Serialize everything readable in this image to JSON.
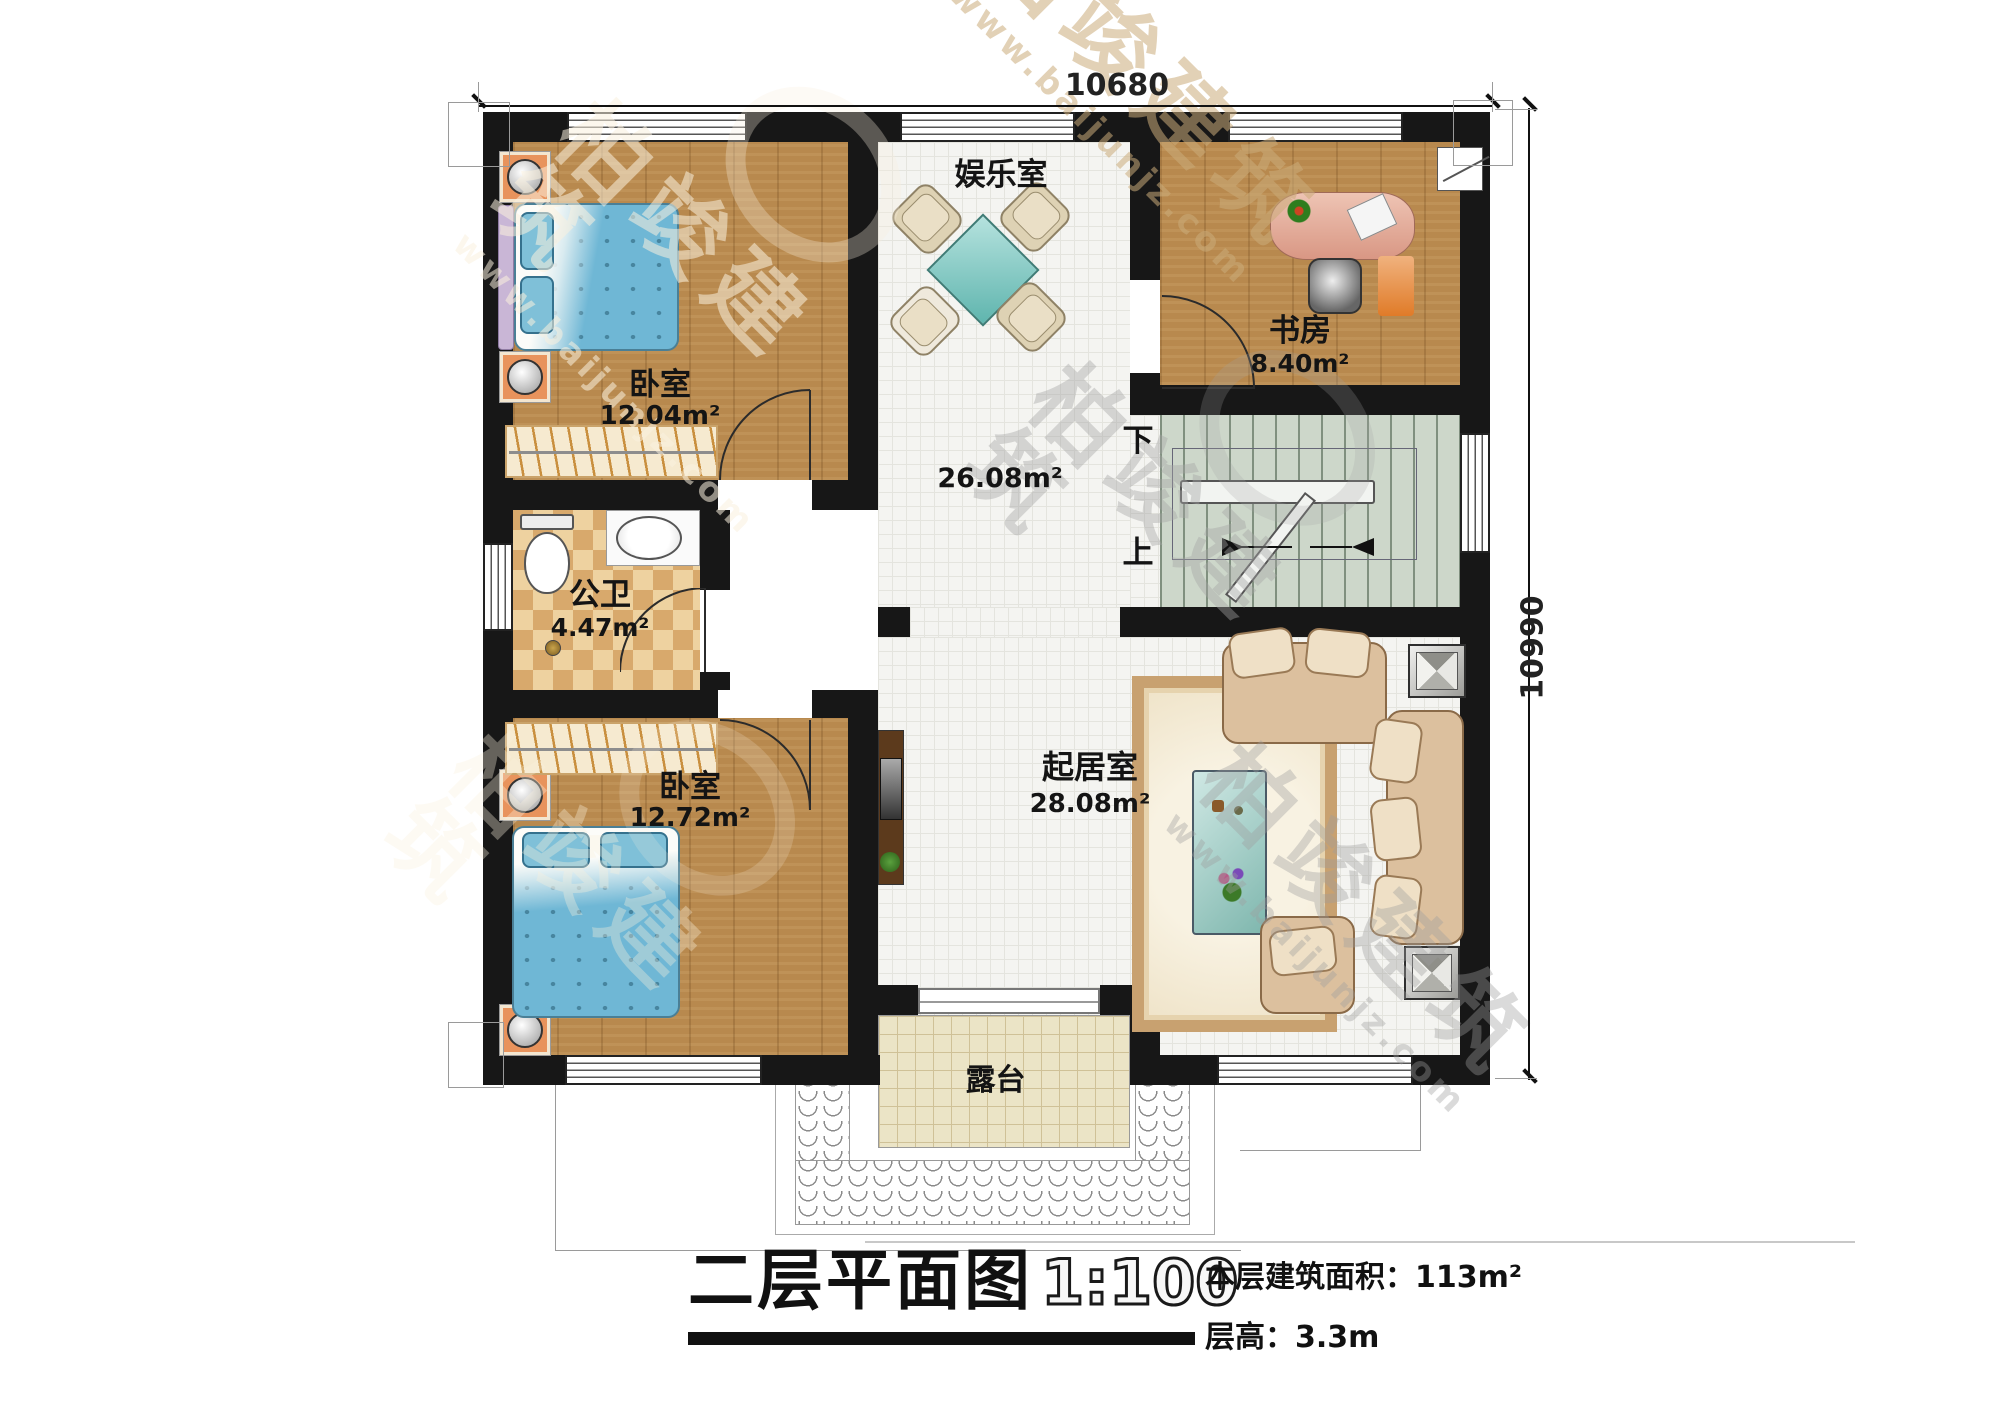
{
  "dimensions": {
    "top": "10680",
    "right": "10990"
  },
  "rooms": {
    "bedroom_top": {
      "label": "卧室",
      "area": "12.04m²"
    },
    "entertainment": {
      "label": "娱乐室"
    },
    "study": {
      "label": "书房",
      "area": "8.40m²"
    },
    "hall": {
      "area": "26.08m²"
    },
    "bathroom": {
      "label": "公卫",
      "area": "4.47m²"
    },
    "bedroom_bottom": {
      "label": "卧室",
      "area": "12.72m²"
    },
    "living": {
      "label": "起居室",
      "area": "28.08m²"
    },
    "terrace": {
      "label": "露台"
    }
  },
  "stairs": {
    "down_label": "下",
    "up_label": "上"
  },
  "titleblock": {
    "title": "二层平面图",
    "scale": "1:100",
    "floor_area": "本层建筑面积：113m²",
    "floor_height": "层高：3.3m"
  },
  "watermark": {
    "brand": "柏竣建筑",
    "url": "www.baijunjz.com"
  },
  "colors": {
    "wall": "#171717",
    "wood_floor": "#b8894e",
    "tile_floor": "#f4f4f1",
    "stair_floor": "#cdd7ca",
    "terrace_floor": "#ebe4c6",
    "table_teal": "#79c7c2",
    "bed_blue": "#6fb7d5",
    "desk_pink": "#e0a392"
  }
}
